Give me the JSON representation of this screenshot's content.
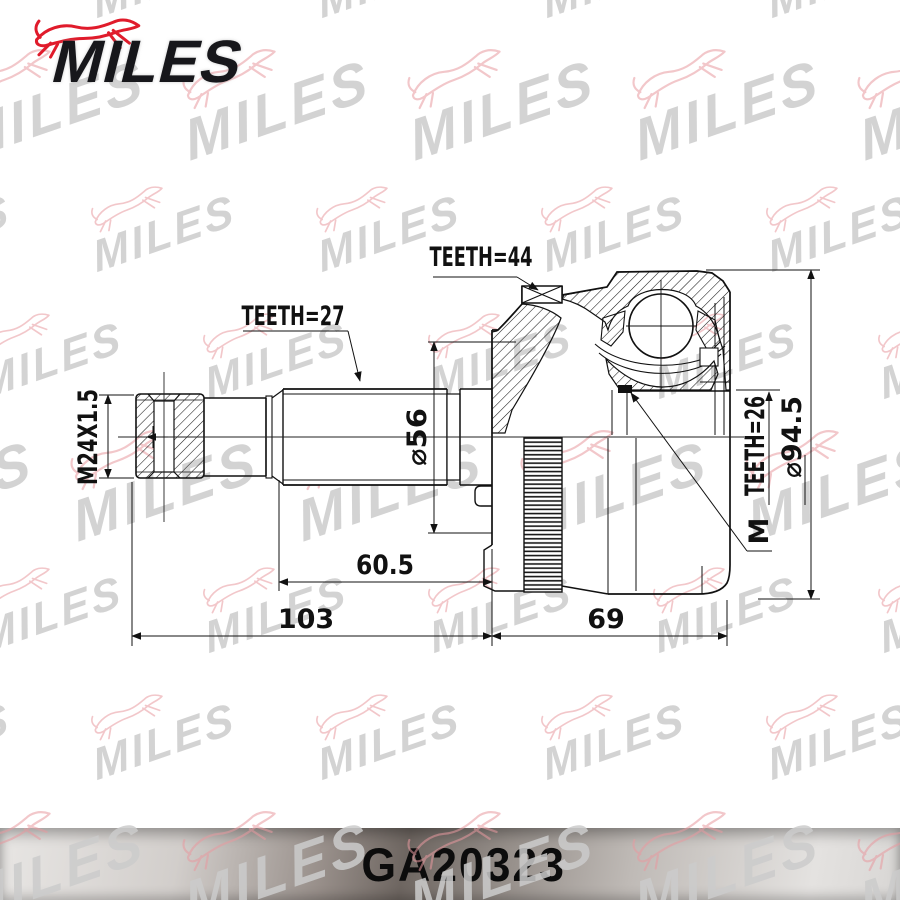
{
  "brand": {
    "logo_text": "MILES",
    "dog_icon": "greyhound-icon"
  },
  "watermark": {
    "text": "MILES"
  },
  "footer": {
    "part_number": "GA20323"
  },
  "labels": {
    "teeth_44": "TEETH=44",
    "teeth_27": "TEETH=27",
    "teeth_26": "TEETH=26",
    "thread": "M24X1.5",
    "dia56": "⌀56",
    "dia945": "⌀94.5",
    "len605": "60.5",
    "len103": "103",
    "len69": "69",
    "marker_m": "M"
  },
  "colors": {
    "logo_red": "#e01b2b",
    "logo_black": "#17171b",
    "line": "#111111",
    "watermark_text": "#cccccc",
    "watermark_dog": "#e89aa0",
    "footer_dark": "#6e6661",
    "footer_light": "#e8e6e4"
  }
}
